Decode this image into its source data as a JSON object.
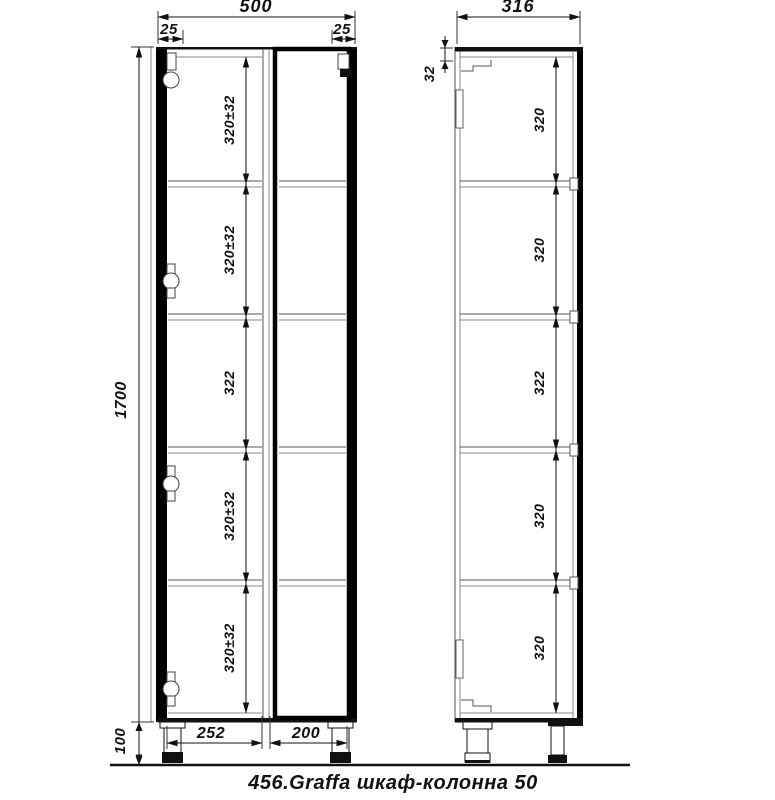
{
  "title": "456.Graffa шкаф-колонна 50",
  "front": {
    "total_width": "500",
    "left_offset": "25",
    "right_offset": "25",
    "total_height": "1700",
    "leg_height": "100",
    "left_width": "252",
    "right_width": "200",
    "shelves": [
      "320±32",
      "320±32",
      "322",
      "320±32",
      "320±32"
    ]
  },
  "side": {
    "total_depth": "316",
    "top_thickness": "32",
    "shelves": [
      "320",
      "320",
      "322",
      "320",
      "320"
    ]
  }
}
